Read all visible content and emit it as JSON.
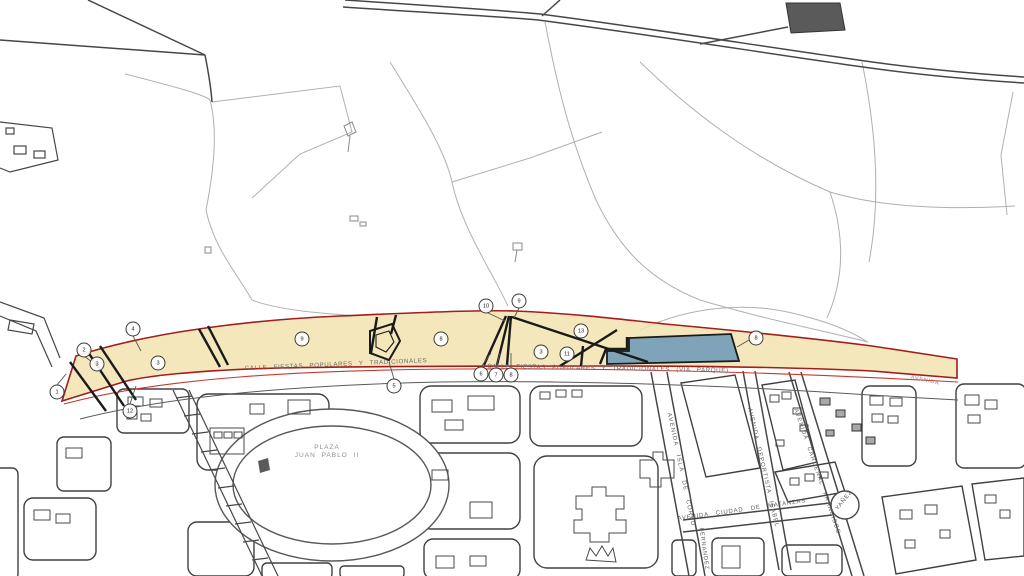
{
  "map": {
    "colors": {
      "strip_fill": "#f3e2ad",
      "strip_outline": "#a31d1d",
      "street_red": "#c63a2e",
      "water_fill": "#7fa3b8",
      "black_lines": "#1a1a1a",
      "roads_gray": "#474747",
      "rural_gray": "#b0b0b0"
    },
    "labels": [
      {
        "id": "street-calle-fiestas-left",
        "text": "CALLE   FIESTAS   POPULARES   Y   TRADICIONALES",
        "x": 336,
        "y": 365,
        "rotate": -2.5,
        "size": 6.2,
        "spacing": 0.6,
        "word": 4,
        "color": "#6a6a6a"
      },
      {
        "id": "street-calle-fiestas-right",
        "text": "CALLE  FIESTAS  POPULARES  Y  TRADICIONALES   (VIA  PARQUE)",
        "x": 608,
        "y": 369,
        "rotate": 1,
        "size": 6.2,
        "spacing": 0.6,
        "word": 4,
        "color": "#6a6a6a"
      },
      {
        "id": "place-plaza-juan-pablo-ii",
        "text": "PLAZA\nJUAN  PABLO  II",
        "x": 327,
        "y": 452,
        "rotate": 0,
        "size": 6.5,
        "spacing": 1,
        "word": 3,
        "color": "#8f8f8f"
      },
      {
        "id": "street-avenida-isla-de-corfu",
        "text": "AVENIDA   ISLA   DE   CORFU",
        "x": 680,
        "y": 470,
        "rotate": 78,
        "size": 6,
        "spacing": 1.2,
        "word": 6,
        "color": "#5f5f5f"
      },
      {
        "id": "street-avenida-deportista-isabel",
        "text": "AVENIDA  DEPORTISTA  ISABEL",
        "x": 762,
        "y": 468,
        "rotate": 77,
        "size": 6,
        "spacing": 1,
        "word": 5,
        "color": "#5f5f5f"
      },
      {
        "id": "street-avenida-cardenal-francisco",
        "text": "AVENIDA  CARDENAL  FRANCISCO",
        "x": 816,
        "y": 472,
        "rotate": 71,
        "size": 6,
        "spacing": 1,
        "word": 5,
        "color": "#5f5f5f"
      },
      {
        "id": "street-avenida-ciudad-de-matanzas",
        "text": "AVENIDA   CIUDAD   DE   MATANZAS",
        "x": 742,
        "y": 511,
        "rotate": -8,
        "size": 6,
        "spacing": 0.8,
        "word": 5,
        "color": "#5f5f5f"
      },
      {
        "id": "street-yanez",
        "text": "YAÑEZ",
        "x": 845,
        "y": 501,
        "rotate": -52,
        "size": 6,
        "spacing": 0.8,
        "word": 2,
        "color": "#5f5f5f"
      },
      {
        "id": "street-fernandez",
        "text": "FERNANDEZ",
        "x": 703,
        "y": 549,
        "rotate": 82,
        "size": 5.8,
        "spacing": 0.8,
        "word": 2,
        "color": "#5f5f5f"
      },
      {
        "id": "street-avenida-right-tip",
        "text": "AVENIDA",
        "x": 925,
        "y": 381,
        "rotate": 13,
        "size": 5.5,
        "spacing": 0.8,
        "word": 2,
        "color": "#8a8a8a"
      }
    ],
    "markers": [
      {
        "n": "1",
        "x": 57,
        "y": 392
      },
      {
        "n": "2",
        "x": 84,
        "y": 350
      },
      {
        "n": "3",
        "x": 97,
        "y": 364
      },
      {
        "n": "4",
        "x": 133,
        "y": 329
      },
      {
        "n": "12",
        "x": 130,
        "y": 411
      },
      {
        "n": "3",
        "x": 158,
        "y": 363
      },
      {
        "n": "9",
        "x": 302,
        "y": 339
      },
      {
        "n": "5",
        "x": 394,
        "y": 386
      },
      {
        "n": "8",
        "x": 441,
        "y": 339
      },
      {
        "n": "10",
        "x": 486,
        "y": 306
      },
      {
        "n": "9",
        "x": 519,
        "y": 301
      },
      {
        "n": "6",
        "x": 481,
        "y": 374
      },
      {
        "n": "7",
        "x": 496,
        "y": 375
      },
      {
        "n": "8",
        "x": 511,
        "y": 375
      },
      {
        "n": "3",
        "x": 541,
        "y": 352
      },
      {
        "n": "11",
        "x": 567,
        "y": 354
      },
      {
        "n": "13",
        "x": 581,
        "y": 331
      },
      {
        "n": "8",
        "x": 756,
        "y": 338
      }
    ]
  }
}
